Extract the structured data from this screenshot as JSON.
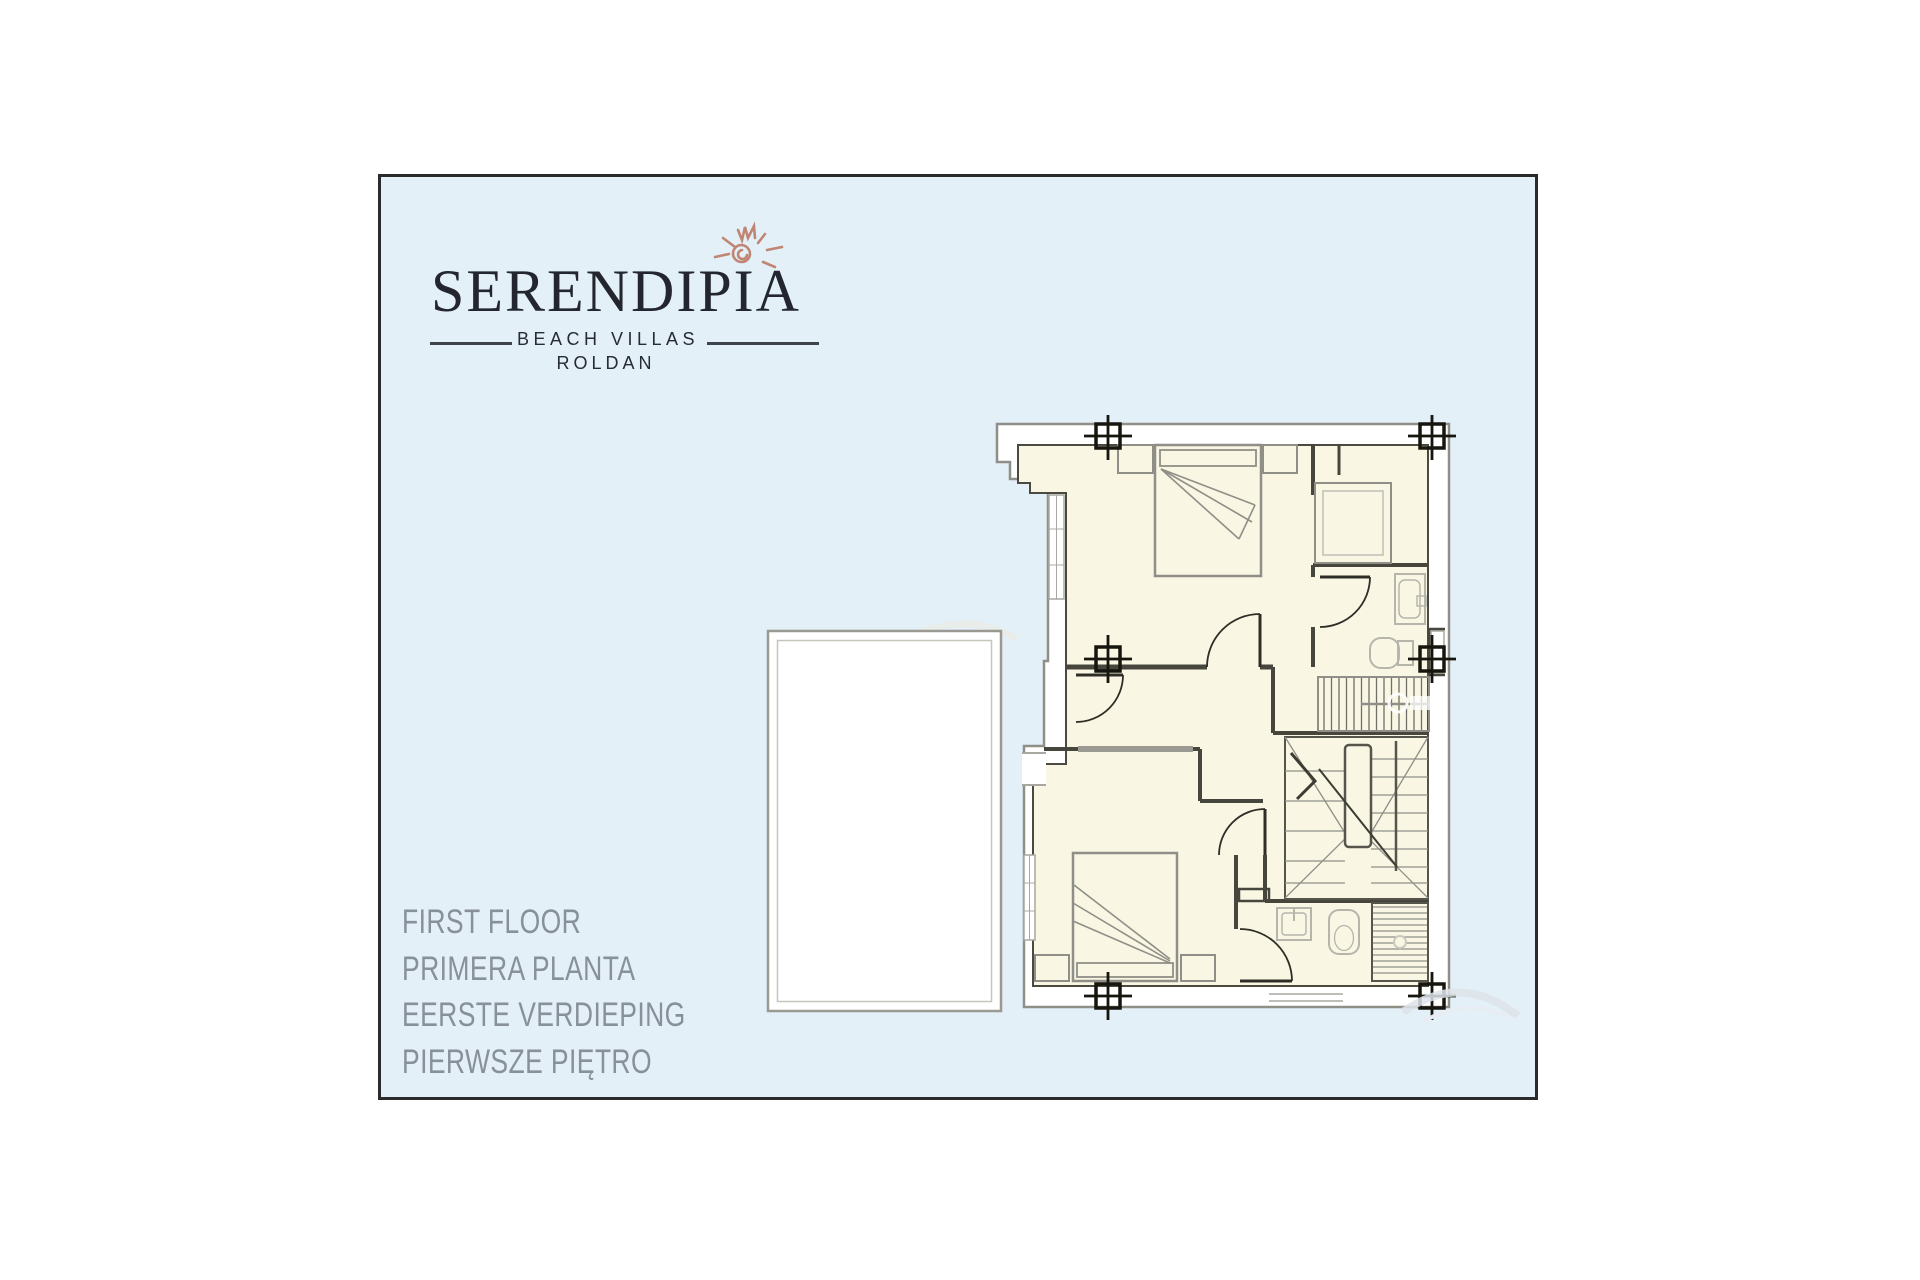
{
  "panel": {
    "background": "#e3f0f8",
    "border_color": "#2b2b2b"
  },
  "logo": {
    "title": "SERENDIPIA",
    "subtitle": "BEACH VILLAS",
    "location": "ROLDAN",
    "text_color": "#23262e",
    "sun_icon_color": "#c08573"
  },
  "floor_labels": [
    "FIRST FLOOR",
    "PRIMERA PLANTA",
    "EERSTE VERDIEPING",
    "PIERWSZE PIĘTRO"
  ],
  "floor_labels_color": "#87909b",
  "floorplan": {
    "room_fill": "#f9f6e3",
    "outer_band": "#ffffff",
    "wall_dark": "#46463c",
    "line_gray": "#8f8f87",
    "fixture_gray": "#b5b5ac",
    "elements": [
      "terrace-roof",
      "bedroom-bed-top",
      "bedroom-bed-bottom",
      "nightstands",
      "walk-in-wardrobe",
      "bathroom-shower-top",
      "toilet-top",
      "sink-bottom",
      "toilet-bottom",
      "shower-bottom",
      "staircase-upper-flight",
      "staircase-winder",
      "door-swings",
      "windows",
      "column-markers"
    ]
  }
}
